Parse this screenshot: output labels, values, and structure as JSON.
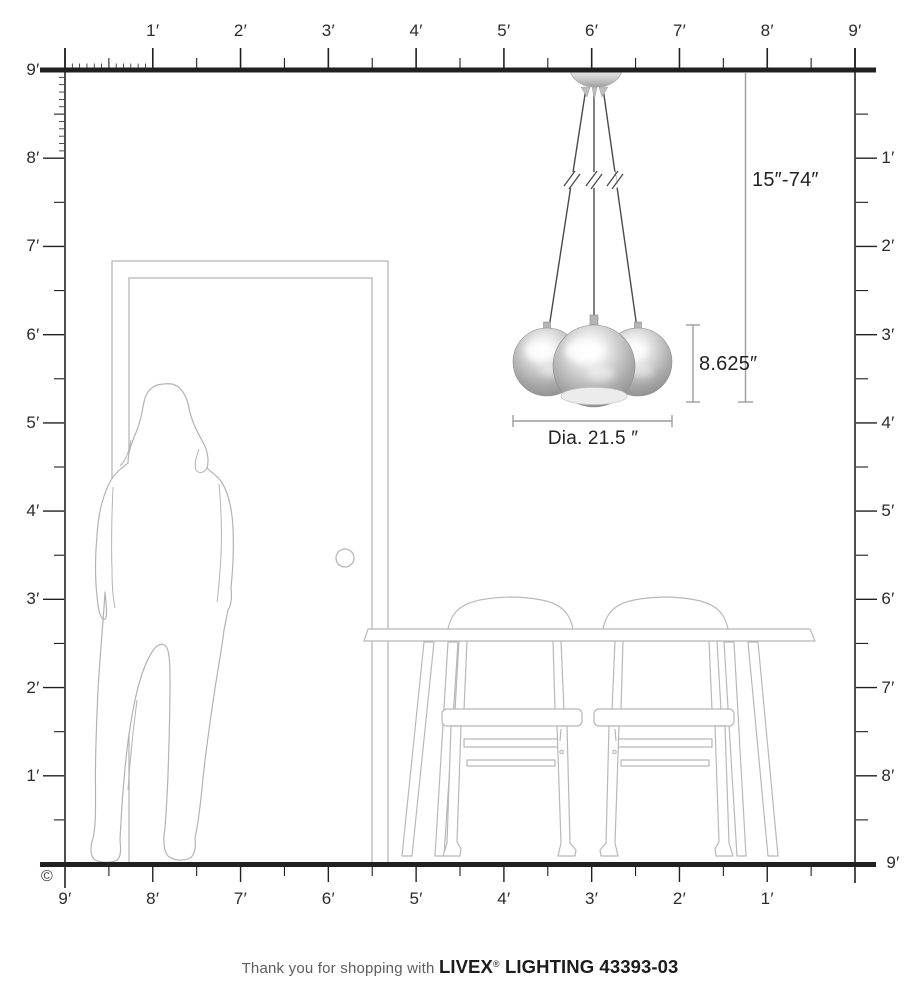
{
  "diagram": {
    "dims": {
      "range": "15″-74″",
      "height": "8.625″",
      "diameter": "Dia. 21.5 ″"
    },
    "rulers": {
      "top": {
        "labels": [
          "1′",
          "2′",
          "3′",
          "4′",
          "5′",
          "6′",
          "7′",
          "8′",
          "9′"
        ]
      },
      "left": {
        "labels": [
          "9′",
          "8′",
          "7′",
          "6′",
          "5′",
          "4′",
          "3′",
          "2′",
          "1′"
        ]
      },
      "right": {
        "labels": [
          "1′",
          "2′",
          "3′",
          "4′",
          "5′",
          "6′",
          "7′",
          "8′"
        ],
        "floor_label": "9′"
      },
      "bottom": {
        "labels": [
          "9′",
          "8′",
          "7′",
          "6′",
          "5′",
          "4′",
          "3′",
          "2′",
          "1′"
        ]
      }
    },
    "copyright_symbol": "©"
  },
  "footer": {
    "prefix": "Thank you for shopping with ",
    "brand": "LIVEX",
    "registered_mark": "®",
    "suffix": " LIGHTING 43393-03"
  },
  "colors": {
    "ruler_line": "#231f20",
    "dimension_line": "#9c9c9c",
    "furniture_outline": "#b8b8b8",
    "silhouette_outline": "#b3b3b3",
    "cord": "#4a4a4a",
    "chrome_dark": "#8a8a8a",
    "chrome_light": "#fafafa"
  }
}
